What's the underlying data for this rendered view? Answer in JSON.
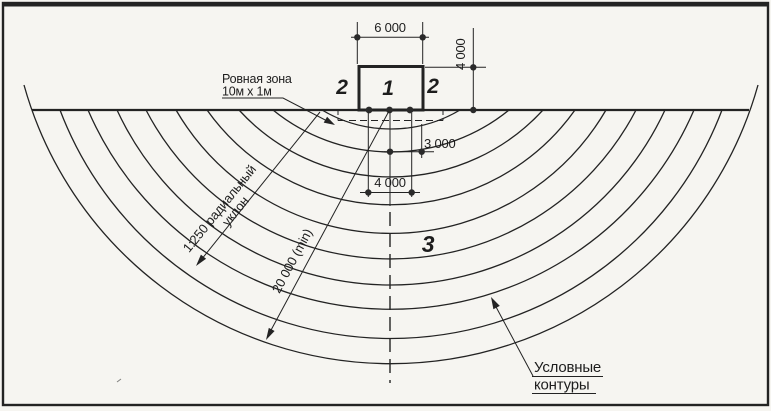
{
  "drawing": {
    "zone_markers": {
      "center": "1",
      "left": "2",
      "right": "2",
      "outer": "3"
    },
    "dimensions": {
      "top_width": "6 000",
      "right_height": "4 000",
      "inner_offset": "3 000",
      "outer_offset": "4 000",
      "min_radius": "20 000 (min)"
    },
    "slope_note": {
      "line1": "1:250 радиальный",
      "line2": "уклон"
    },
    "flat_zone_note": {
      "line1": "Ровная зона",
      "line2": "10м х 1м"
    },
    "contours_note": {
      "line1": "Условные",
      "line2": "контуры"
    },
    "colors": {
      "ink": "#232323",
      "paper": "#f6f5f1"
    }
  }
}
